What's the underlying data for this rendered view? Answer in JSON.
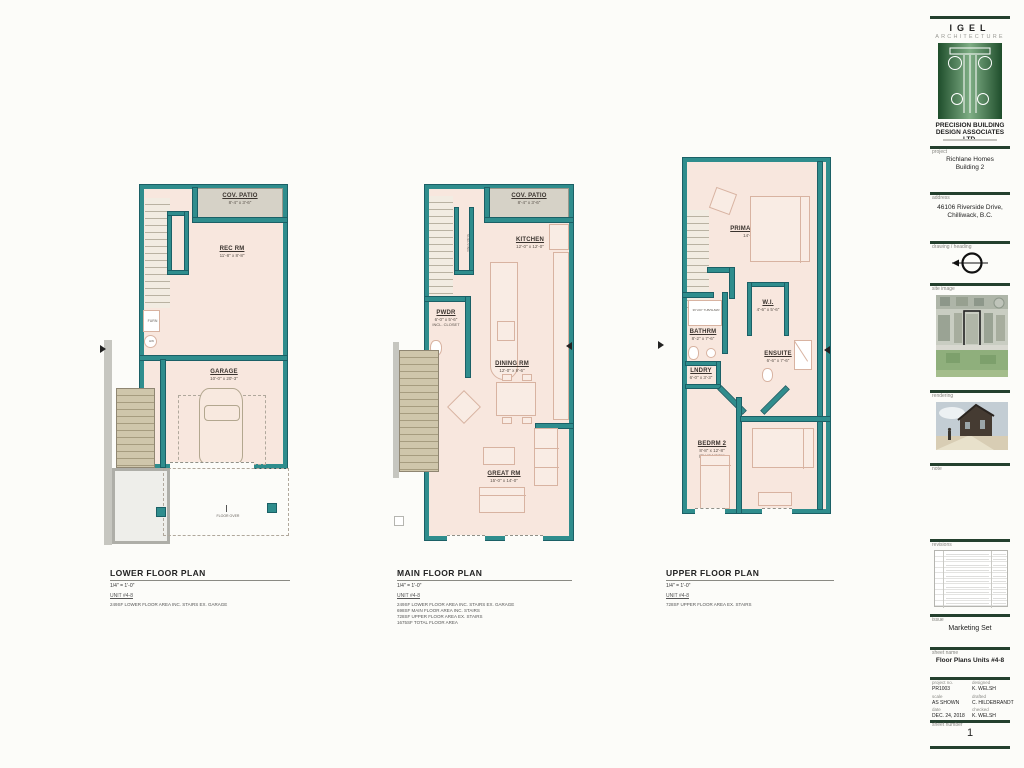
{
  "colors": {
    "wall_teal": "#2f8d8d",
    "floor_peach": "#f8e7de",
    "patio_gray": "#d6d2c7",
    "bar_green": "#24402e",
    "logo_green": "#1e4d2b"
  },
  "plans": [
    {
      "title": "LOWER FLOOR PLAN",
      "scale": "1/4\" = 1'-0\"",
      "unit": "UNIT #4-8",
      "notes": [
        "249SF  LOWER FLOOR AREA INC. STAIRS EX. GARAGE"
      ],
      "rooms": [
        {
          "name": "COV. PATIO",
          "dims": "8'-4\" x 3'-6\""
        },
        {
          "name": "REC RM",
          "dims": "11'-8\" x 8'-8\""
        },
        {
          "name": "GARAGE",
          "dims": "10'-0\" x 20'-3\""
        }
      ],
      "annotations": {
        "furn": "FURN",
        "hw": "HW",
        "floor_over": "FLOOR OVER"
      }
    },
    {
      "title": "MAIN FLOOR PLAN",
      "scale": "1/4\" = 1'-0\"",
      "unit": "UNIT #4-8",
      "notes": [
        "249SF  LOWER FLOOR AREA INC. STAIRS EX. GARAGE",
        "698SF  MAIN FLOOR AREA INC. STAIRS",
        "728SF  UPPER FLOOR AREA EX. STAIRS",
        "1675SF  TOTAL FLOOR AREA"
      ],
      "rooms": [
        {
          "name": "COV. PATIO",
          "dims": "8'-4\" x 3'-6\""
        },
        {
          "name": "KITCHEN",
          "dims": "12'-0\" x 12'-0\""
        },
        {
          "name": "PWDR",
          "dims": "6'-0\" x 5'-6\"",
          "extra": "INCL. CLOSET"
        },
        {
          "name": "DINING RM",
          "dims": "12'-0\" x 9'-6\""
        },
        {
          "name": "GREAT RM",
          "dims": "15'-0\" x 14'-0\""
        }
      ],
      "annotations": {
        "shelving": "SHELVING"
      }
    },
    {
      "title": "UPPER FLOOR PLAN",
      "scale": "1/4\" = 1'-0\"",
      "unit": "UNIT #4-8",
      "notes": [
        "728SF  UPPER FLOOR AREA EX. STAIRS"
      ],
      "rooms": [
        {
          "name": "PRIMARY BEDRM",
          "dims": "14'-3\" x 13'-0\""
        },
        {
          "name": "W.I.",
          "dims": "4'-6\" x 5'-6\""
        },
        {
          "name": "BATHRM",
          "dims": "8'-2\" x 7'-6\""
        },
        {
          "name": "ENSUITE",
          "dims": "6'-6\" x 7'-6\""
        },
        {
          "name": "LNDRY",
          "dims": "6'-0\" x 3'-3\""
        },
        {
          "name": "BEDRM 2",
          "dims": "8'-8\" x 12'-8\"",
          "extra": "(PLUS NOOK)"
        },
        {
          "name": "BEDRM 3",
          "dims": "8'-8\" x 11'-6\""
        }
      ],
      "annotations": {
        "tub": "36\"x60\" TUB/SHWR"
      }
    }
  ],
  "titleblock": {
    "firm_name": "IGEL",
    "firm_type": "ARCHITECTURE",
    "company_line1": "PRECISION BUILDING",
    "company_line2": "DESIGN ASSOCIATES LTD.",
    "sections": {
      "project": {
        "label": "project",
        "line1": "Richlane Homes",
        "line2": "Building 2"
      },
      "address": {
        "label": "address",
        "line1": "46106 Riverside Drive,",
        "line2": "Chilliwack, B.C."
      },
      "drawing_heading": {
        "label": "drawing / heading"
      },
      "site_image": {
        "label": "site image"
      },
      "rendering": {
        "label": "rendering"
      },
      "note": {
        "label": "note"
      },
      "revisions": {
        "label": "revisions",
        "row_count": 10
      },
      "issue": {
        "label": "issue",
        "value": "Marketing Set"
      },
      "sheet_name": {
        "label": "sheet name",
        "value": "Floor Plans Units #4-8"
      },
      "info": {
        "project_no_label": "project no.",
        "project_no": "PR1003",
        "designed_label": "designed",
        "designed": "K. WELSH",
        "scale_label": "scale",
        "scale": "AS SHOWN",
        "drafted_label": "drafted",
        "drafted": "C. HILDEBRANDT",
        "date_label": "date",
        "date": "DEC. 24, 2018",
        "checked_label": "checked",
        "checked": "K. WELSH"
      },
      "sheet_number": {
        "label": "sheet number",
        "value": "1"
      }
    }
  }
}
